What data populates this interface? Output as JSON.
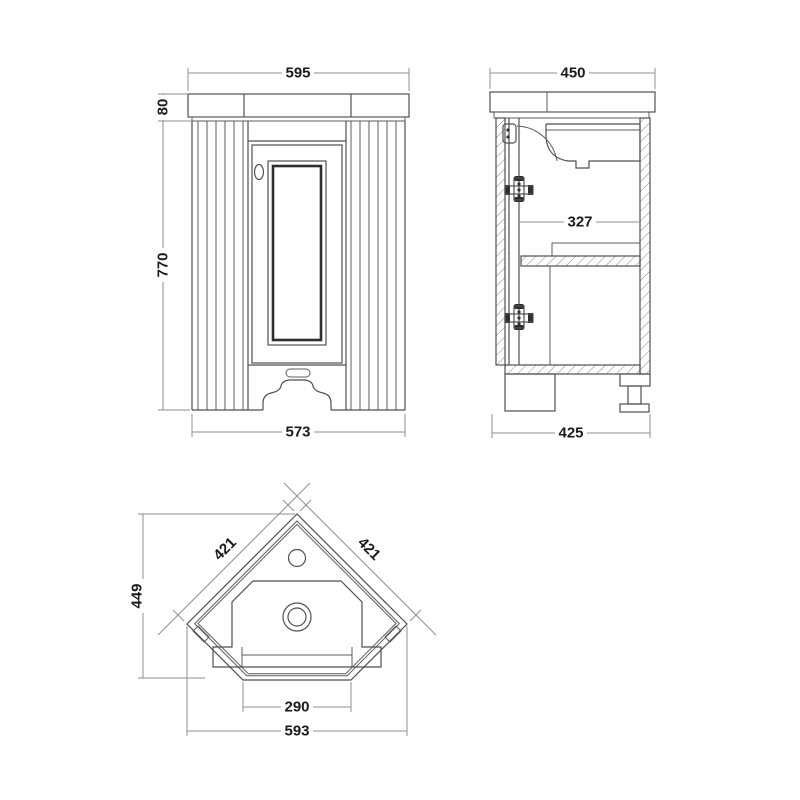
{
  "views": {
    "front": {
      "dims": {
        "overall_width": "595",
        "worktop_height": "80",
        "cabinet_height": "770",
        "cabinet_width": "573"
      }
    },
    "side": {
      "dims": {
        "worktop_depth": "450",
        "internal_depth": "327",
        "cabinet_depth": "425"
      }
    },
    "plan": {
      "dims": {
        "back_left": "421",
        "back_right": "421",
        "overall_depth": "449",
        "front_width": "290",
        "overall_width": "593"
      }
    }
  },
  "colors": {
    "line": "#4f4f4f",
    "line_dark": "#2e2e2e",
    "dimension_line": "#8f8f8f",
    "text": "#1a1a1a",
    "background": "#ffffff"
  }
}
